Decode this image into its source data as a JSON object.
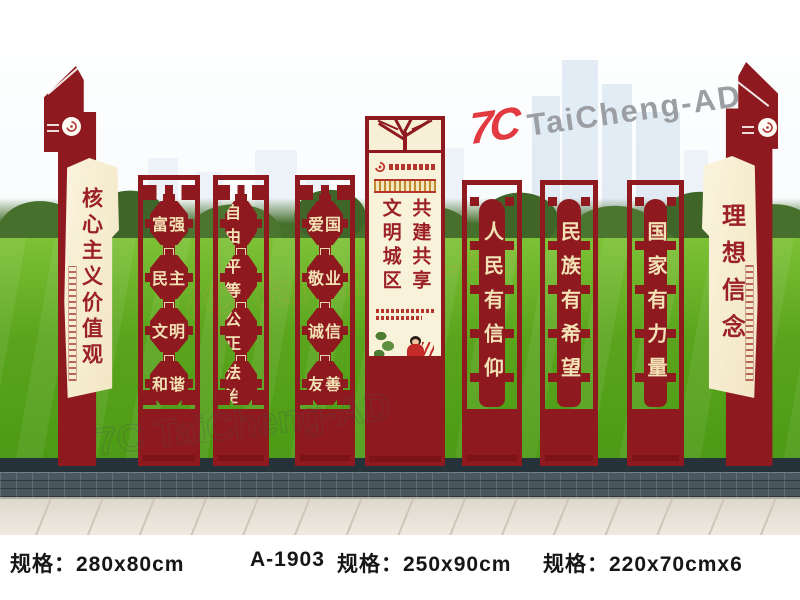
{
  "watermarks": {
    "top_mark": "7C",
    "top_name": "TaiCheng-AD",
    "mid_text": "7C TaiCheng-AD",
    "low_text": "7C TaiCheng-AD"
  },
  "boards": {
    "left_flag": {
      "title": "核心主义价值观"
    },
    "value_panels": [
      {
        "rows": [
          "富强",
          "民主",
          "文明",
          "和谐"
        ]
      },
      {
        "rows": [
          "自由",
          "平等",
          "公正",
          "法治"
        ]
      },
      {
        "rows": [
          "爱国",
          "敬业",
          "诚信",
          "友善"
        ]
      }
    ],
    "center": {
      "col_left": "文明城区",
      "col_right": "共建共享"
    },
    "slogan_panels": [
      {
        "text": "人民有信仰"
      },
      {
        "text": "民族有希望"
      },
      {
        "text": "国家有力量"
      }
    ],
    "right_flag": {
      "title": "理想信念"
    }
  },
  "specs": [
    {
      "label": "规格：280x80cm"
    },
    {
      "label": "A-1903"
    },
    {
      "label": "规格：250x90cm"
    },
    {
      "label": "规格：220x70cmx6"
    }
  ],
  "colors": {
    "board_red": "#8e1a1f",
    "board_red_dark": "#7c1317",
    "cream": "#f1e5c2",
    "cream_text": "#f2e2b6",
    "text_red": "#9c2126",
    "grass_green": "#4c9a15",
    "tree_green": "#47702c",
    "sky_building": "#d9e5f0",
    "wall_gray": "#4a575f",
    "pavement": "#efebe2",
    "logo_red": "#e23a40",
    "logo_gray": "#9b9fa3",
    "spec_text": "#161616"
  }
}
